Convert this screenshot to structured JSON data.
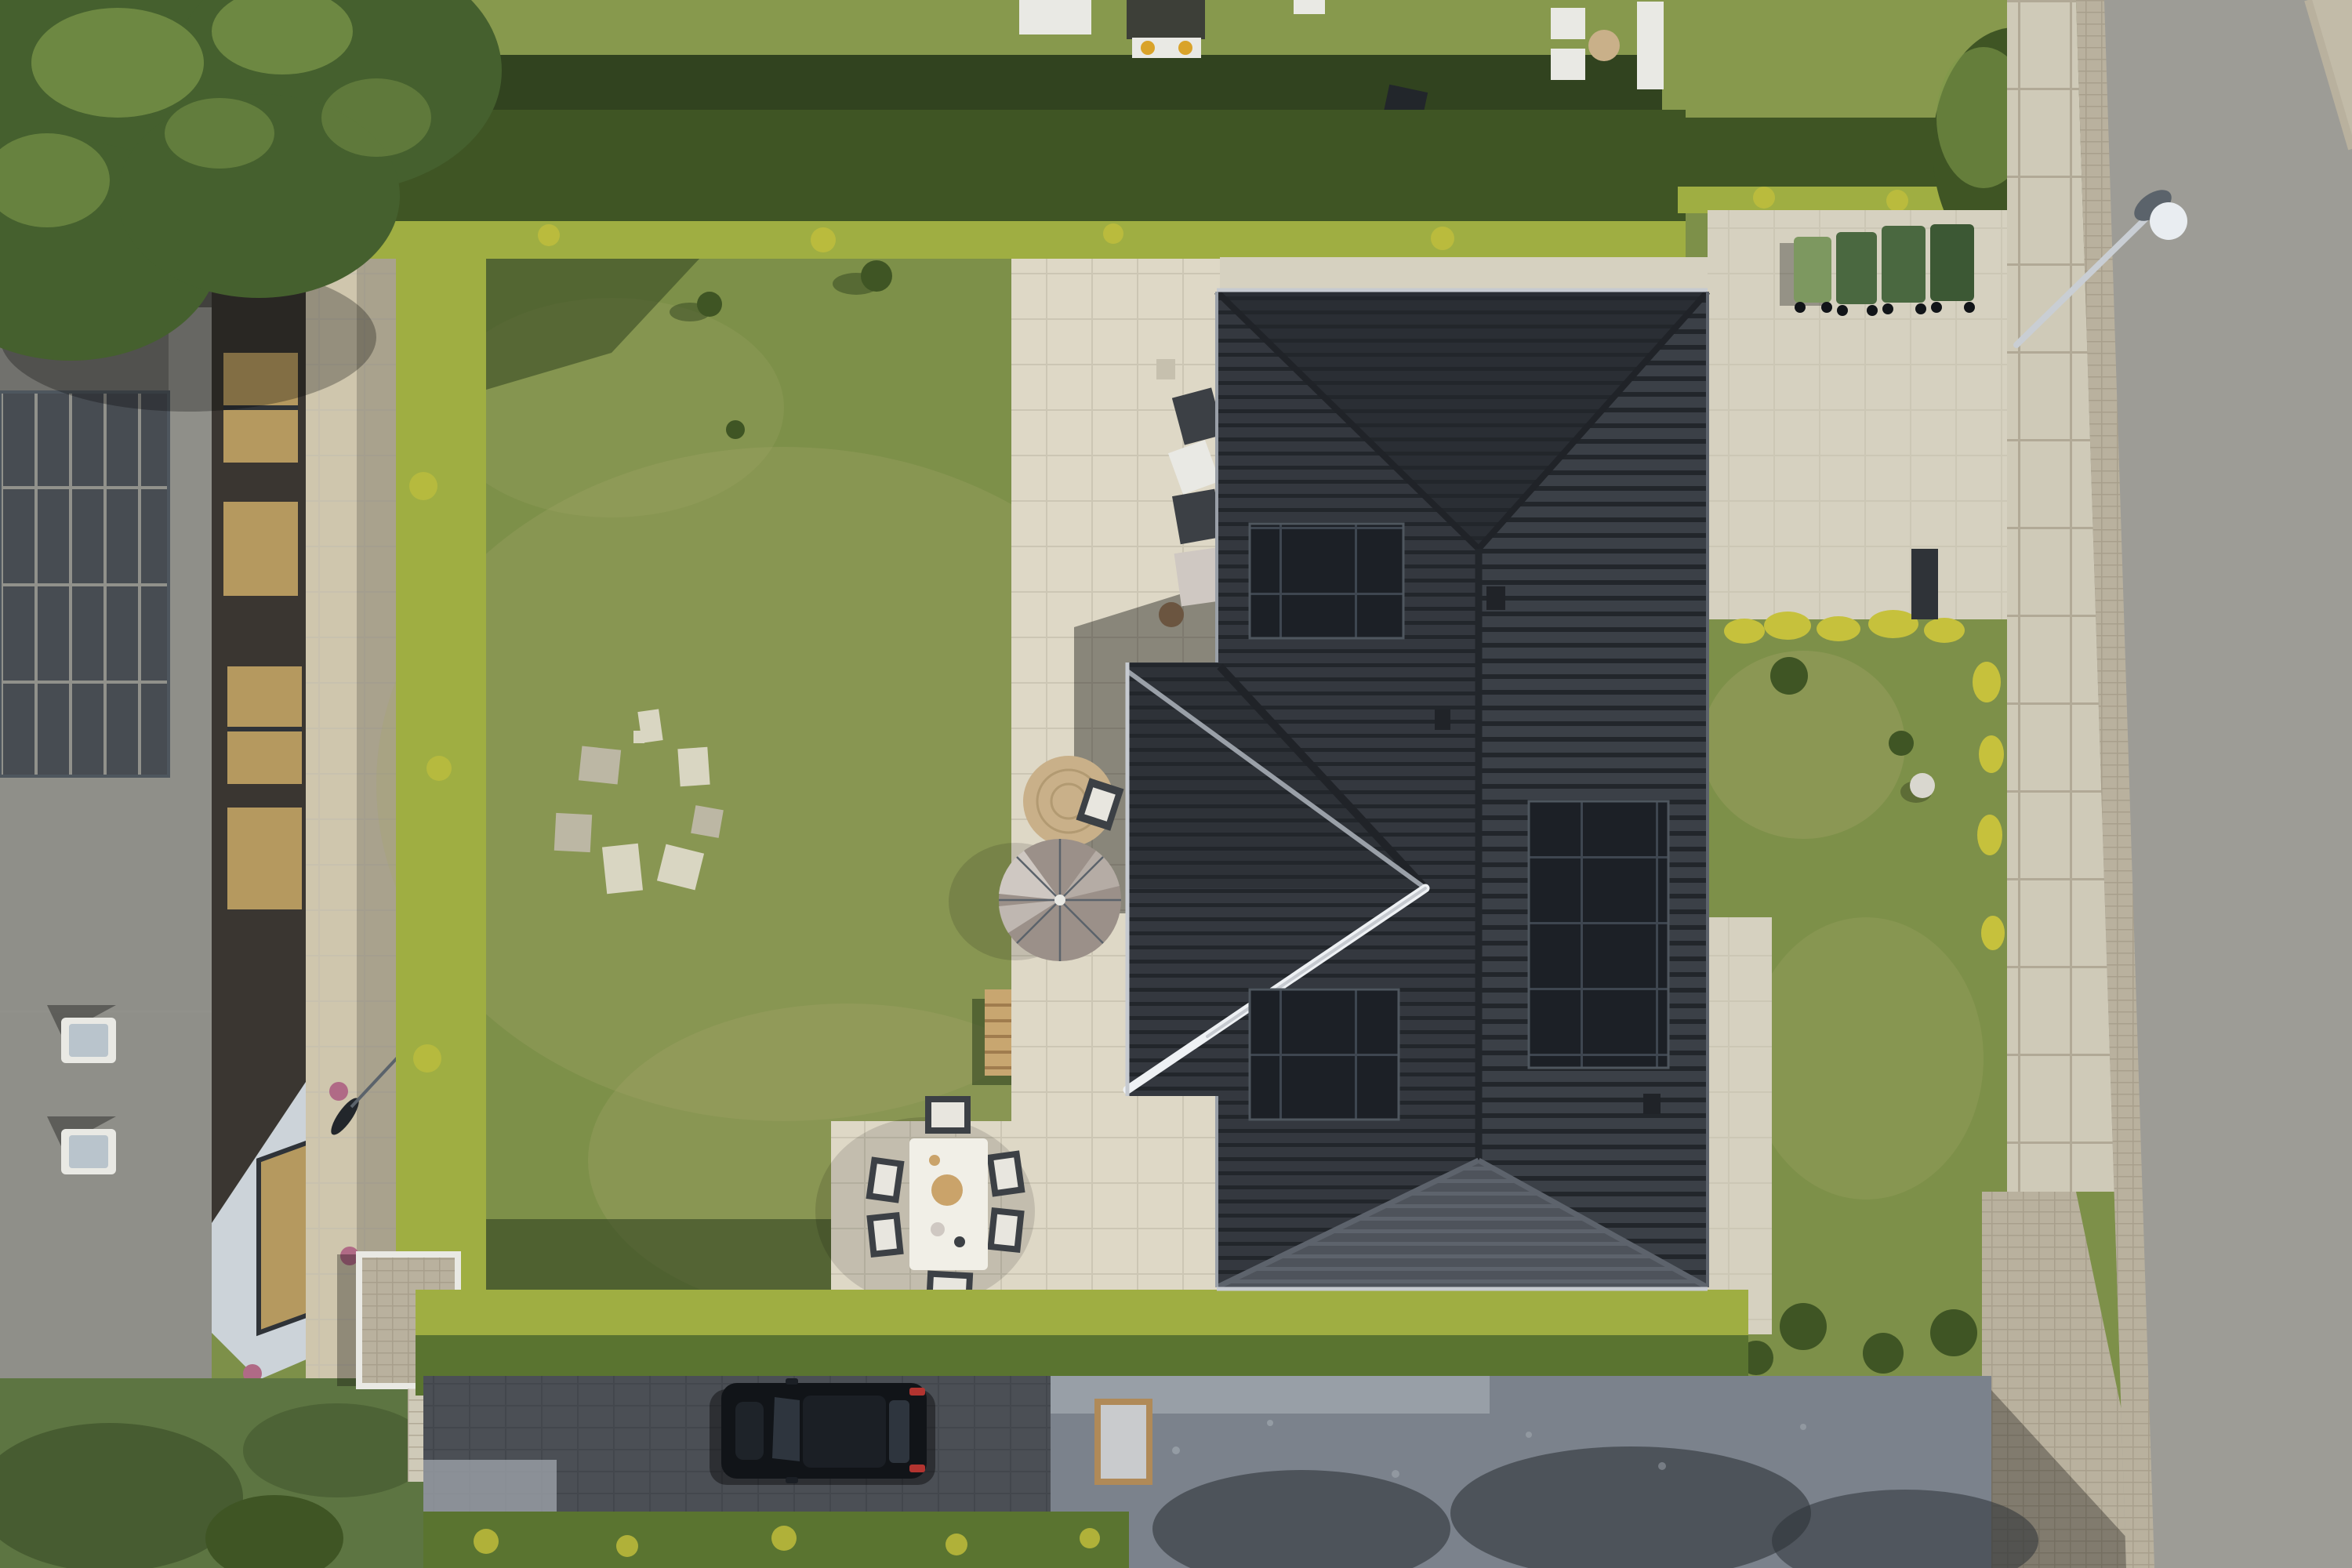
{
  "scene": {
    "description": "Top-down aerial drone photo: modern single-family house with dark tiled hip roof and three rooftop solar arrays, cream paver patio with taupe parasol and white dining set, hedged lawn with circle of pale patches, neighbouring flat-roof house with large solar array on the left, wheelie bins and paved driveway top right, asphalt street with curved street lamp on the right, black car parked on shaded bottom driveway lane",
    "counts": {
      "solar_arrays_main_roof": 3,
      "wheelie_bins": 4,
      "dining_chairs": 6,
      "pale_lawn_patches": 8,
      "skylights_left_building": 2
    }
  },
  "p": {
    "grassBase": "#7d9049",
    "grassSunlit": "#8a9c52",
    "grassDry": "#a6a76b",
    "grassShadow": "#31431f",
    "grassNeighbor": "#87994d",
    "grassBottomLeft": "#5d7542",
    "hedgeDark": "#3f5524",
    "hedgeMid": "#5a7430",
    "hedgeSunlit": "#9fae42",
    "hedgeYellow": "#c6c13c",
    "treeCanopy": "#45602e",
    "treeHighlight": "#7f9a4b",
    "roofNorth": "#2a2e34",
    "roofEast": "#3b4047",
    "roofWest": "#34383f",
    "roofSouth": "#4e535b",
    "roofLine": "#22262b",
    "roofLineLight": "#5d636c",
    "ridgeGlint": "#eef1f4",
    "ridgeGray": "#9aa0a8",
    "gutter": "#c6cad0",
    "eaveDark": "#202328",
    "panelDark": "#1c2026",
    "panelGrid": "#3e4650",
    "panelFrame": "#4e565e",
    "paverLight": "#ded8c6",
    "paverJoint": "#c6c0ae",
    "paverGray": "#d6d1c0",
    "walkTan": "#cfc6ad",
    "sidewalk": "#cfcab8",
    "cobble": "#b9b19e",
    "cobbleJoint": "#a49b87",
    "road": "#9d9c96",
    "shoulder": "#c2bba8",
    "gravel": "#7b828c",
    "gravelLight": "#a0a6ae",
    "gravelShadow": "#2e3339",
    "laneDark": "#4b4f55",
    "laneJoint": "#3f4349",
    "bldgRoof": "#8f8f89",
    "bldgRoofDark": "#5a5a55",
    "bldgPanel": "#474c52",
    "bldgPanelGap": "#91918b",
    "brick": "#3a3631",
    "windowGold": "#b5995f",
    "windowDark": "#2f3338",
    "wallPale": "#ccd3d9",
    "whiteTrim": "#e9e9e4",
    "skylightGlass": "#b9c4cc",
    "binLight": "#7d9860",
    "binGreen": "#4a6840",
    "binDark": "#3c5834",
    "umbrella": "#9b9089",
    "umbrellaLight": "#cfc8c2",
    "jute": "#c9b089",
    "juteRing": "#b29a72",
    "woodLight": "#c8a670",
    "woodSlat": "#a07c4e",
    "woodFrame": "#b08a58",
    "frameInner": "#c9cbcd",
    "furnDark": "#3c4045",
    "cushion": "#e8e6df",
    "tableWhite": "#f1efe7",
    "boardWood": "#caa36a",
    "carBody": "#111418",
    "carGlass": "#2e353e",
    "carRoof": "#1b1f25",
    "carRed": "#b23430",
    "lampHead": "#e9edf1",
    "lampArm": "#c9ced4",
    "lampCap": "#5b636b",
    "stoneDome": "#d9d7cf",
    "potPink": "#b06a86",
    "potSoil": "#6b5540",
    "shadow": "#000000",
    "patchWhite": "#d9d6c2",
    "patchGray": "#bcb7a4",
    "playRoof": "#3d3f38",
    "awningYellow": "#d9a32a"
  }
}
